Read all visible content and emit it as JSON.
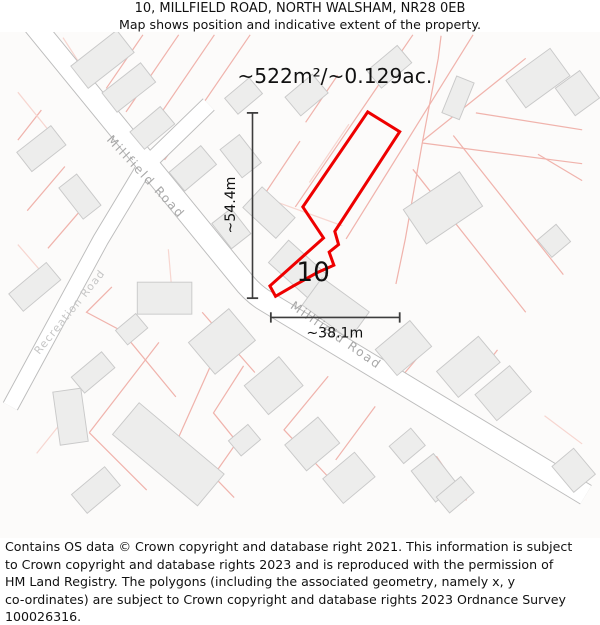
{
  "header": {
    "title": "10, MILLFIELD ROAD, NORTH WALSHAM, NR28 0EB",
    "subtitle": "Map shows position and indicative extent of the property."
  },
  "map": {
    "area_label": {
      "text": "~522m²/~0.129ac.",
      "x": 337,
      "y": 86,
      "size": 21.5
    },
    "plot_number": {
      "text": "10",
      "x": 314,
      "y": 297,
      "size": 28
    },
    "dimension_vertical": {
      "label": "~54.4m",
      "x": 249.5,
      "y1": 118,
      "y2": 315,
      "label_x": 231,
      "label_y": 216,
      "cap": 6,
      "size": 15
    },
    "dimension_horizontal": {
      "label": "~38.1m",
      "y": 335.5,
      "x1": 269,
      "x2": 406,
      "label_x": 337,
      "label_y": 357,
      "cap": 5.5,
      "size": 15
    },
    "road_labels": [
      {
        "text": "Millfield Road",
        "x": 133,
        "y": 189,
        "angle": 47,
        "size": 13,
        "spacing": 2,
        "light": false
      },
      {
        "text": "Millfield Road",
        "x": 336,
        "y": 358,
        "angle": 35,
        "size": 13,
        "spacing": 2,
        "light": false
      },
      {
        "text": "Recreation Road",
        "x": 58,
        "y": 332,
        "angle": -51,
        "size": 11.5,
        "spacing": 1.2,
        "light": true
      }
    ],
    "property_outline_points": "372,117 406,138 337,244 341,258 331,266 336,280 318,288 293,302 274,313 268,302 325,251 303,218",
    "roads": [
      {
        "name": "millfield-road",
        "path": "M 2,6 L 238,295 Q 248,308 260,316 L 604,524",
        "width": 22
      },
      {
        "name": "recreation-road",
        "path": "M 203,109 L 135,175 L 88,253 L 18,382 L -8,430",
        "width": 16
      }
    ],
    "parcel_lines": [
      {
        "pts": "133,35 94,92"
      },
      {
        "pts": "171,35 115,117"
      },
      {
        "pts": "209,35 136,142"
      },
      {
        "pts": "247,35 156,168"
      },
      {
        "pts": "48,38 143,185",
        "light": true
      },
      {
        "pts": "143,185 205,262",
        "light": true
      },
      {
        "pts": "25,115 0,147"
      },
      {
        "pts": "50,175 10,222"
      },
      {
        "pts": "75,212 32,262"
      },
      {
        "pts": "0,96 42,148",
        "light": true
      },
      {
        "pts": "100,303 73,330 120,355"
      },
      {
        "pts": "0,258 38,302",
        "light": true
      },
      {
        "pts": "60,430 20,480",
        "light": true
      },
      {
        "pts": "420,35 295,218"
      },
      {
        "pts": "484,35 349,252"
      },
      {
        "pts": "540,60 430,148"
      },
      {
        "pts": "430,150 600,172"
      },
      {
        "pts": "487,118 600,136"
      },
      {
        "pts": "553,162 600,190"
      },
      {
        "pts": "450,36 447,60 430,150 412,252 402,300"
      },
      {
        "pts": "420,178 540,330"
      },
      {
        "pts": "463,142 580,290"
      },
      {
        "pts": "432,370 405,402"
      },
      {
        "pts": "510,370 477,413"
      },
      {
        "pts": "445,483 477,530"
      },
      {
        "pts": "330,398 283,455 330,505"
      },
      {
        "pts": "380,430 338,487"
      },
      {
        "pts": "150,362 76,458"
      },
      {
        "pts": "76,458 137,519"
      },
      {
        "pts": "208,380 170,465"
      },
      {
        "pts": "170,465 230,527"
      },
      {
        "pts": "240,387 208,437 233,468 212,498"
      },
      {
        "pts": "160,263 163,298",
        "light": true
      },
      {
        "pts": "112,352 168,420"
      },
      {
        "pts": "196,330 252,394"
      },
      {
        "pts": "560,440 600,470",
        "light": true
      },
      {
        "pts": "300,148 262,205"
      },
      {
        "pts": "340,78 306,128"
      },
      {
        "pts": "352,130 310,192",
        "light": true
      },
      {
        "pts": "262,208 345,238",
        "light": true
      }
    ],
    "buildings": [
      {
        "cx": 90,
        "cy": 61,
        "w": 62,
        "h": 30,
        "rot": -38
      },
      {
        "cx": 118,
        "cy": 91,
        "w": 52,
        "h": 26,
        "rot": -38
      },
      {
        "cx": 143,
        "cy": 134,
        "w": 42,
        "h": 24,
        "rot": -40
      },
      {
        "cx": 186,
        "cy": 177,
        "w": 44,
        "h": 26,
        "rot": -40
      },
      {
        "cx": 25,
        "cy": 156,
        "w": 46,
        "h": 26,
        "rot": -38
      },
      {
        "cx": 66,
        "cy": 207,
        "w": 24,
        "h": 42,
        "rot": -38
      },
      {
        "cx": 18,
        "cy": 303,
        "w": 52,
        "h": 24,
        "rot": -40
      },
      {
        "cx": 240,
        "cy": 100,
        "w": 34,
        "h": 22,
        "rot": -40
      },
      {
        "cx": 307,
        "cy": 99,
        "w": 38,
        "h": 26,
        "rot": -40
      },
      {
        "cx": 395,
        "cy": 69,
        "w": 42,
        "h": 24,
        "rot": -40
      },
      {
        "cx": 468,
        "cy": 102,
        "w": 20,
        "h": 42,
        "rot": 22
      },
      {
        "cx": 553,
        "cy": 81,
        "w": 58,
        "h": 36,
        "rot": -36
      },
      {
        "cx": 595,
        "cy": 97,
        "w": 32,
        "h": 36,
        "rot": -36
      },
      {
        "cx": 452,
        "cy": 219,
        "w": 72,
        "h": 44,
        "rot": -34
      },
      {
        "cx": 570,
        "cy": 254,
        "w": 26,
        "h": 24,
        "rot": -40
      },
      {
        "cx": 237,
        "cy": 164,
        "w": 26,
        "h": 38,
        "rot": -38
      },
      {
        "cx": 227,
        "cy": 241,
        "w": 26,
        "h": 34,
        "rot": -38
      },
      {
        "cx": 267,
        "cy": 224,
        "w": 48,
        "h": 30,
        "rot": 43
      },
      {
        "cx": 298,
        "cy": 284,
        "w": 56,
        "h": 32,
        "rot": 42
      },
      {
        "cx": 338,
        "cy": 326,
        "w": 62,
        "h": 36,
        "rot": 36
      },
      {
        "cx": 410,
        "cy": 368,
        "w": 48,
        "h": 36,
        "rot": -40
      },
      {
        "cx": 479,
        "cy": 388,
        "w": 58,
        "h": 36,
        "rot": -40
      },
      {
        "cx": 516,
        "cy": 416,
        "w": 48,
        "h": 36,
        "rot": -40
      },
      {
        "cx": 414,
        "cy": 472,
        "w": 30,
        "h": 24,
        "rot": -40
      },
      {
        "cx": 443,
        "cy": 506,
        "w": 30,
        "h": 42,
        "rot": -38
      },
      {
        "cx": 591,
        "cy": 498,
        "w": 30,
        "h": 36,
        "rot": -40
      },
      {
        "cx": 465,
        "cy": 524,
        "w": 34,
        "h": 22,
        "rot": -40
      },
      {
        "cx": 156,
        "cy": 315,
        "w": 58,
        "h": 34,
        "rot": 0
      },
      {
        "cx": 121,
        "cy": 348,
        "w": 28,
        "h": 20,
        "rot": -40
      },
      {
        "cx": 217,
        "cy": 361,
        "w": 56,
        "h": 44,
        "rot": -40
      },
      {
        "cx": 272,
        "cy": 408,
        "w": 48,
        "h": 40,
        "rot": -40
      },
      {
        "cx": 56,
        "cy": 441,
        "w": 30,
        "h": 57,
        "rot": -8
      },
      {
        "cx": 80,
        "cy": 394,
        "w": 42,
        "h": 22,
        "rot": -40
      },
      {
        "cx": 160,
        "cy": 481,
        "w": 118,
        "h": 44,
        "rot": 40
      },
      {
        "cx": 83,
        "cy": 519,
        "w": 46,
        "h": 26,
        "rot": -40
      },
      {
        "cx": 241,
        "cy": 466,
        "w": 27,
        "h": 21,
        "rot": -40
      },
      {
        "cx": 313,
        "cy": 470,
        "w": 46,
        "h": 36,
        "rot": -40
      },
      {
        "cx": 352,
        "cy": 506,
        "w": 44,
        "h": 34,
        "rot": -40
      }
    ],
    "colors": {
      "property_outline": "#ee0000",
      "building_fill": "#ededec",
      "building_stroke": "#c9c9c9",
      "parcel_line": "#f0b3ac",
      "parcel_line_light": "#f7d6d0",
      "road_edge": "#bcbcbc",
      "road_fill": "#ffffff",
      "dimension": "#3d3d3d",
      "road_label": "#a8a8a8",
      "road_label_light": "#c6c6c6",
      "text": "#111111",
      "map_bg": "#fcfbfa"
    }
  },
  "footer": {
    "lines": [
      "Contains OS data © Crown copyright and database right 2021. This information is subject",
      "to Crown copyright and database rights 2023 and is reproduced with the permission of",
      "HM Land Registry. The polygons (including the associated geometry, namely x, y",
      "co-ordinates) are subject to Crown copyright and database rights 2023 Ordnance Survey",
      "100026316."
    ]
  }
}
